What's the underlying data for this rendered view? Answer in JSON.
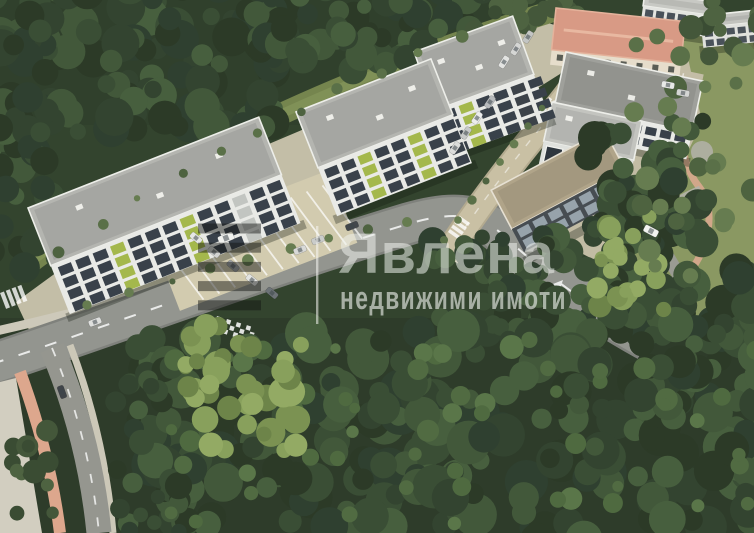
{
  "watermark": {
    "brand": "Явлена",
    "tagline": "недвижими имоти",
    "logo": "stripes-icon",
    "text_color": "#eef1ec",
    "line_color": "#f7f7f4",
    "stripe_color": "#101412"
  },
  "scene": {
    "type": "aerial-3d-render",
    "subject": "residential complex of white apartment buildings along a curving road surrounded by dense forest",
    "colors": {
      "forest_dark": "#33442e",
      "forest_light": "#7b9252",
      "park_grass": "#8a9862",
      "asphalt": "#93958f",
      "access_road": "#c9c0a4",
      "pavement": "#c8c2ab",
      "bike_lane": "#dda78d",
      "building_facade": "#e9eae6",
      "building_dark": "#474d52",
      "roof_gray": "#b4b5b0",
      "roof_pink": "#d89a85",
      "roof_tan": "#b0a489",
      "window": "#39414a",
      "balcony_accent": "#a4b84c"
    }
  }
}
